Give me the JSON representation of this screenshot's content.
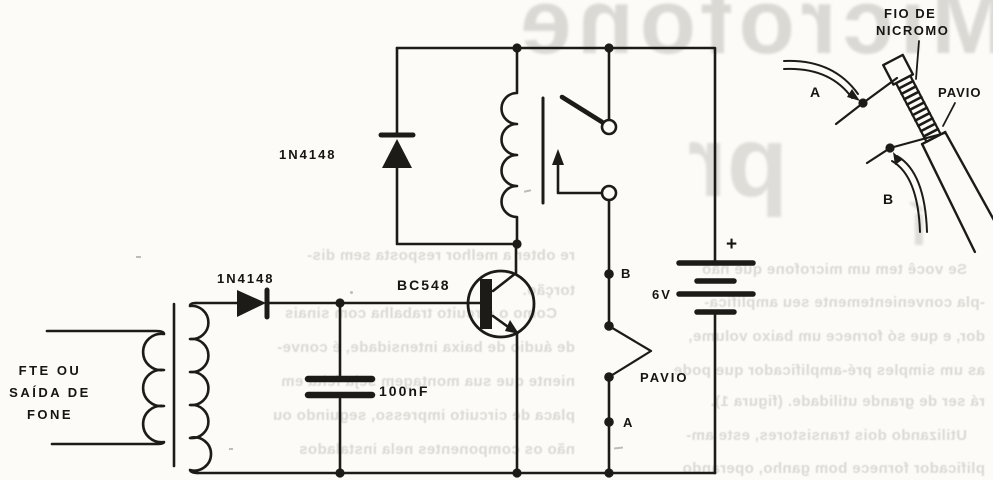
{
  "figure": {
    "labels": {
      "relay_diode": "1N4148",
      "input_diode": "1N4148",
      "transistor": "BC548",
      "capacitor": "100nF",
      "battery_voltage": "6V",
      "battery_plus": "+",
      "point_b": "B",
      "point_a": "A",
      "fuse": "PAVIO",
      "input_line1": "FTE OU",
      "input_line2": "SAÍDA DE",
      "input_line3": "FONE"
    },
    "inset": {
      "nichrome_line1": "FIO DE",
      "nichrome_line2": "NICROMO",
      "wick": "PAVIO",
      "terminal_a": "A",
      "terminal_b": "B"
    }
  },
  "bleedthrough": {
    "title": "Microfone",
    "title_fragment": "pr",
    "title_fragment2": "í",
    "left_column": [
      "re obter a melhor resposta sem dis-",
      "torção.",
      "Como o circuito trabalha com sinais",
      "de áudio de baixa intensidade, é conve-",
      "niente que sua montagem seja feita em",
      "placa de circuito impresso, seguindo ou",
      "não os componentes nela instalados"
    ],
    "right_column": [
      "Se você tem um microfone que não",
      "-pla convenientemente seu amplifica-",
      "dor, e que só fornece um baixo volume,",
      "as um simples pré-amplificador que pode",
      "rá ser de grande utilidade. (figura 1).",
      "Utilizando dois transistores, este am-",
      "plificador fornece bom ganho, operando"
    ]
  },
  "colors": {
    "ink": "#1c1b18",
    "paper": "#fcfbf7",
    "bleed": "#cfcec8"
  }
}
